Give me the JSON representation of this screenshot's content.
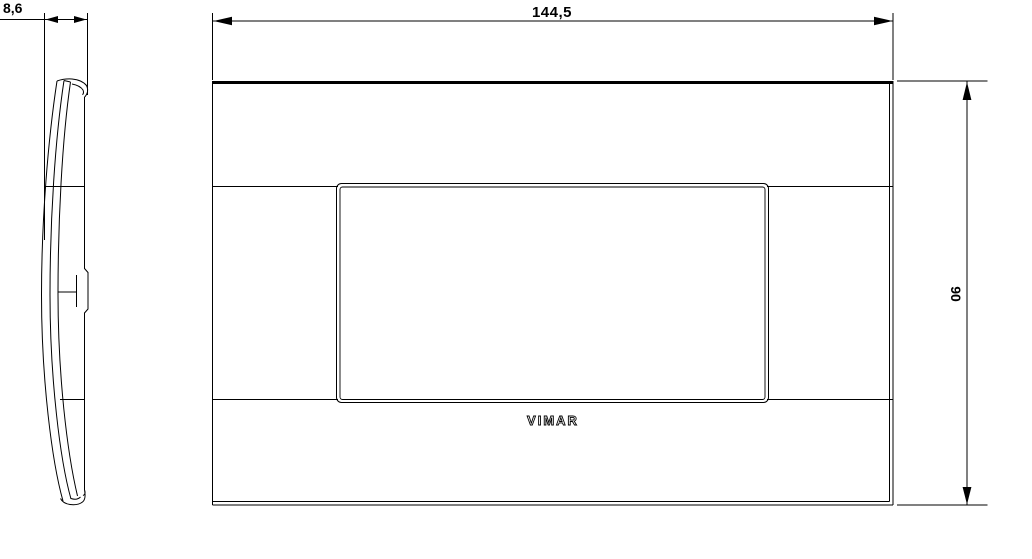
{
  "drawing": {
    "type": "technical-dimension-drawing",
    "colors": {
      "background": "#ffffff",
      "line": "#000000"
    },
    "side_view": {
      "depth_dimension": "8,6"
    },
    "front_view": {
      "width_dimension": "144,5",
      "height_dimension": "90",
      "logo_text": "VIMAR"
    }
  }
}
